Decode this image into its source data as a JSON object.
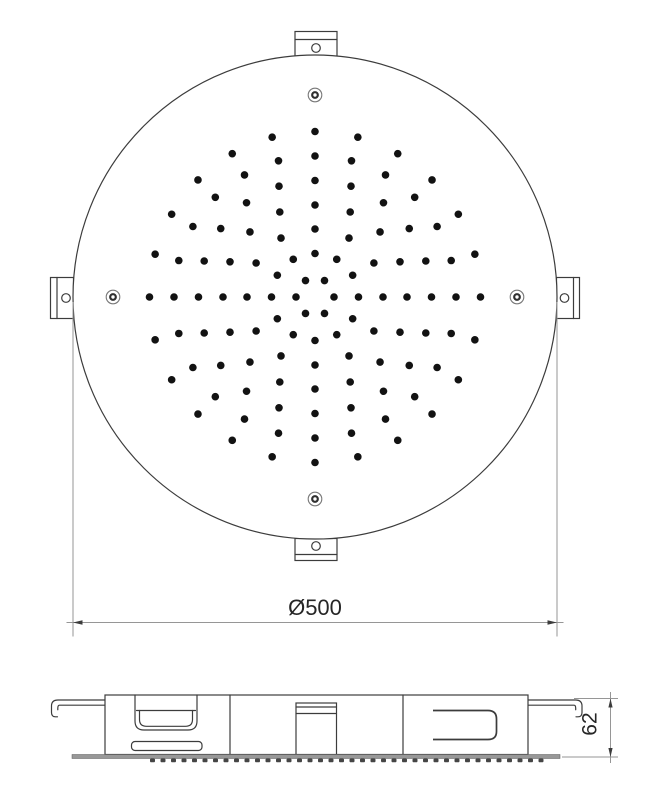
{
  "drawing": {
    "kind": "shower-head-technical-drawing",
    "top_view": {
      "circle": {
        "cx": 315,
        "cy": 297,
        "r": 242
      },
      "nozzle_dot_radius": 3.8,
      "nozzle_rings": [
        {
          "radius": 19,
          "count": 6,
          "offset_deg": 0
        },
        {
          "radius": 43.5,
          "count": 12,
          "offset_deg": 0
        },
        {
          "radius": 68,
          "count": 12,
          "offset_deg": 0
        },
        {
          "radius": 92,
          "count": 16,
          "offset_deg": 0
        },
        {
          "radius": 116.5,
          "count": 20,
          "offset_deg": 0
        },
        {
          "radius": 141,
          "count": 24,
          "offset_deg": 0
        },
        {
          "radius": 165.5,
          "count": 24,
          "offset_deg": 0
        }
      ],
      "screw_holes": {
        "ring_radius": 202,
        "angles_deg": [
          0,
          90,
          180,
          270
        ],
        "outer_r": 6.8,
        "inner_r": 2.8
      }
    },
    "side_view": {
      "nozzle_bumps": {
        "start_x": 150,
        "end_x": 541,
        "step": 10.5,
        "w": 5,
        "h": 3.8,
        "y": 758.5
      }
    },
    "dimensions": {
      "diameter": {
        "label": "Ø500"
      },
      "height": {
        "label": "62"
      }
    },
    "colors": {
      "line": "#3c3c3c",
      "dim": "#969696",
      "text": "#262626",
      "dot": "#121212",
      "plate": "#989898",
      "bump": "#454545",
      "bg": "#ffffff"
    }
  }
}
